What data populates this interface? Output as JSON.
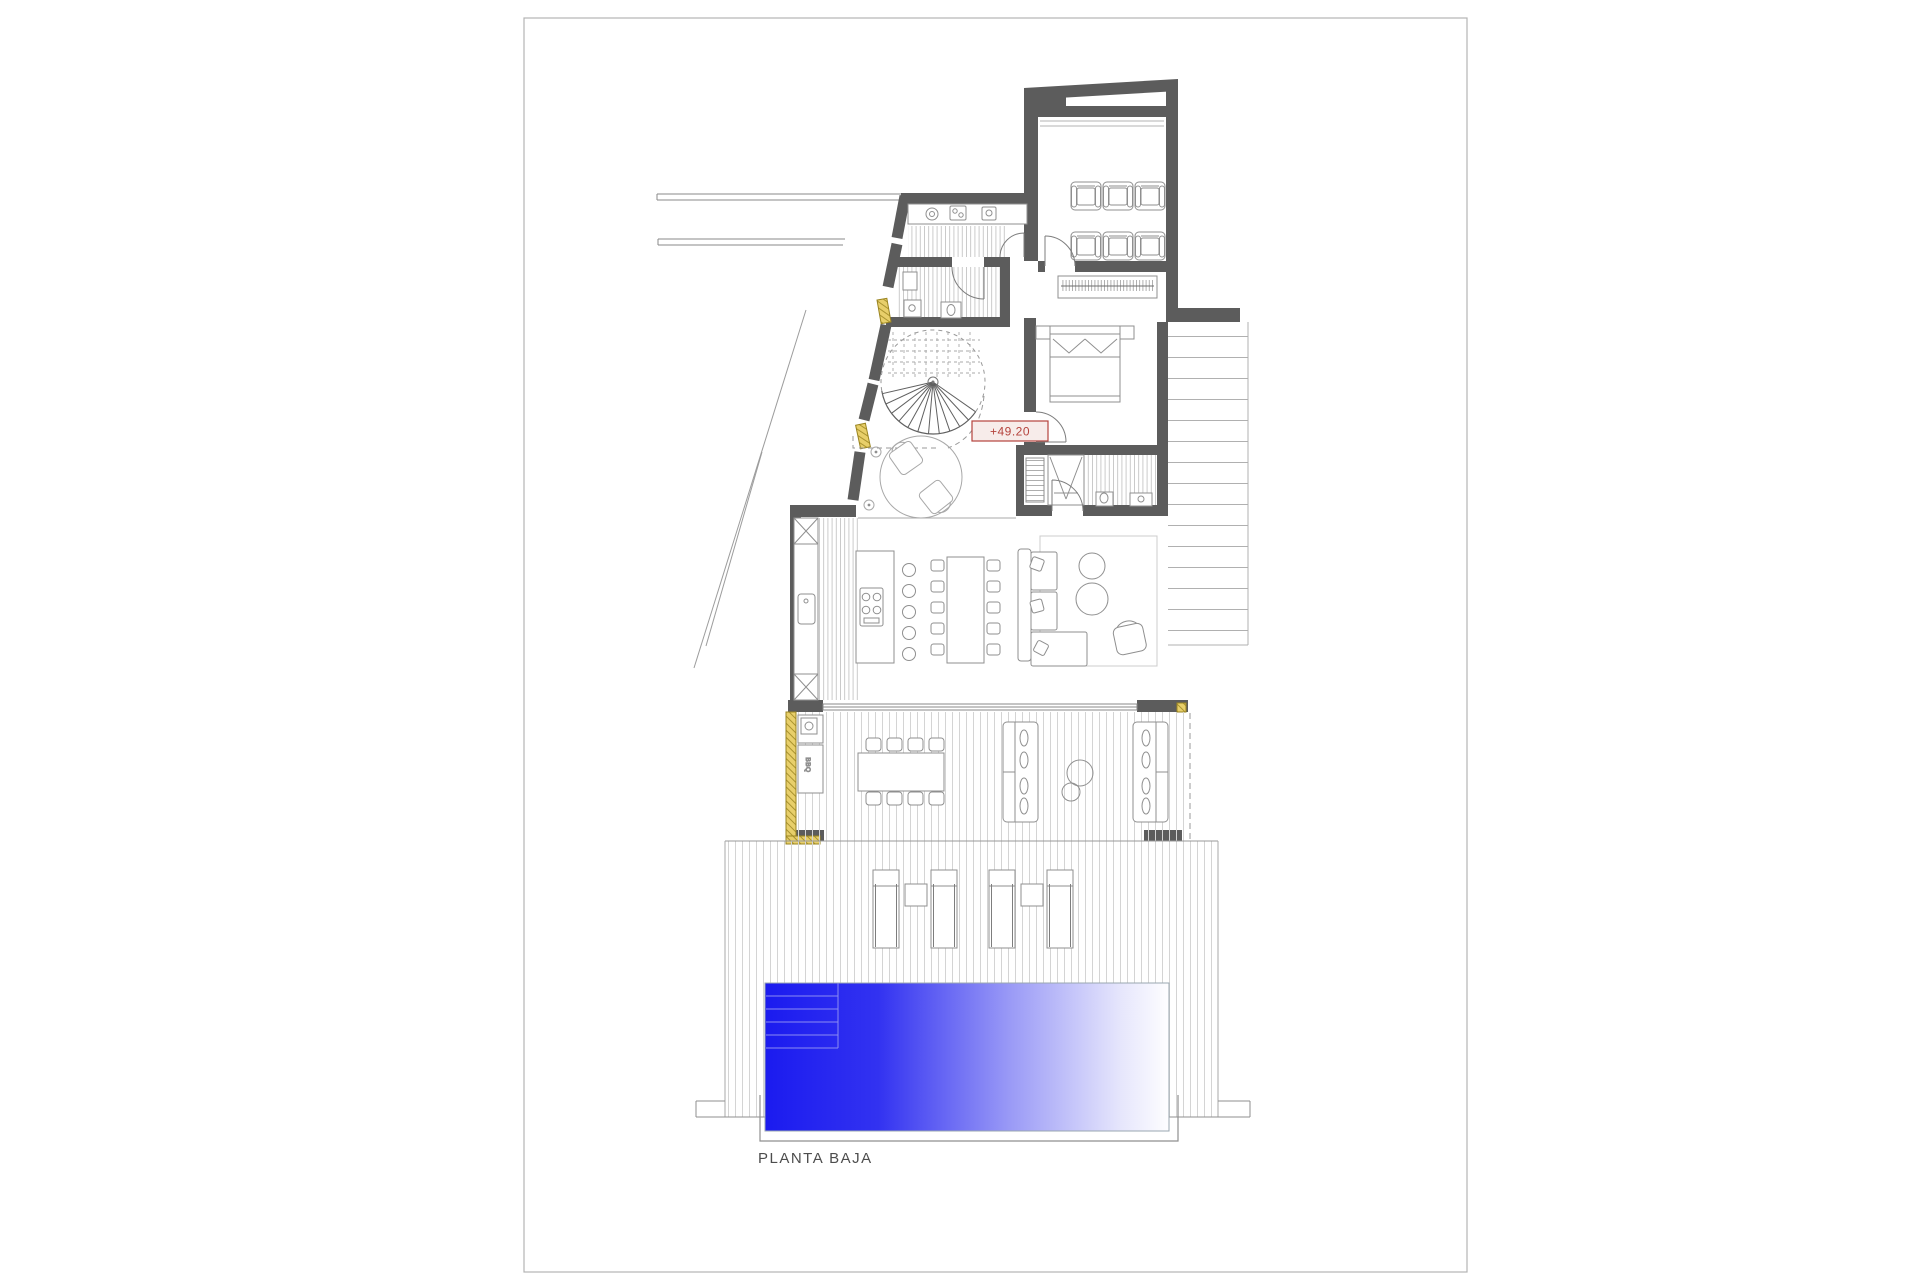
{
  "document": {
    "kind": "architectural floor plan",
    "title": "PLANTA BAJA",
    "level_marker": "+49.20",
    "bbq_label": "BBQ",
    "colors": {
      "wall": "#5c5c5c",
      "sheet_border": "#b3b3b3",
      "floor_line": "#bdbdbd",
      "deck_line": "#d4d4d4",
      "furniture_line": "#8f8f8f",
      "window_marker_fill": "#e8cf6a",
      "window_marker_stroke": "#9a8420",
      "level_marker_red": "#b5433d",
      "level_marker_fill": "#f7ecea",
      "pool_deep_blue": "#1b1bef",
      "pool_shallow": "#ffffff",
      "pool_step_line": "#8c8cf2",
      "title_color": "#4d4d4d"
    }
  }
}
